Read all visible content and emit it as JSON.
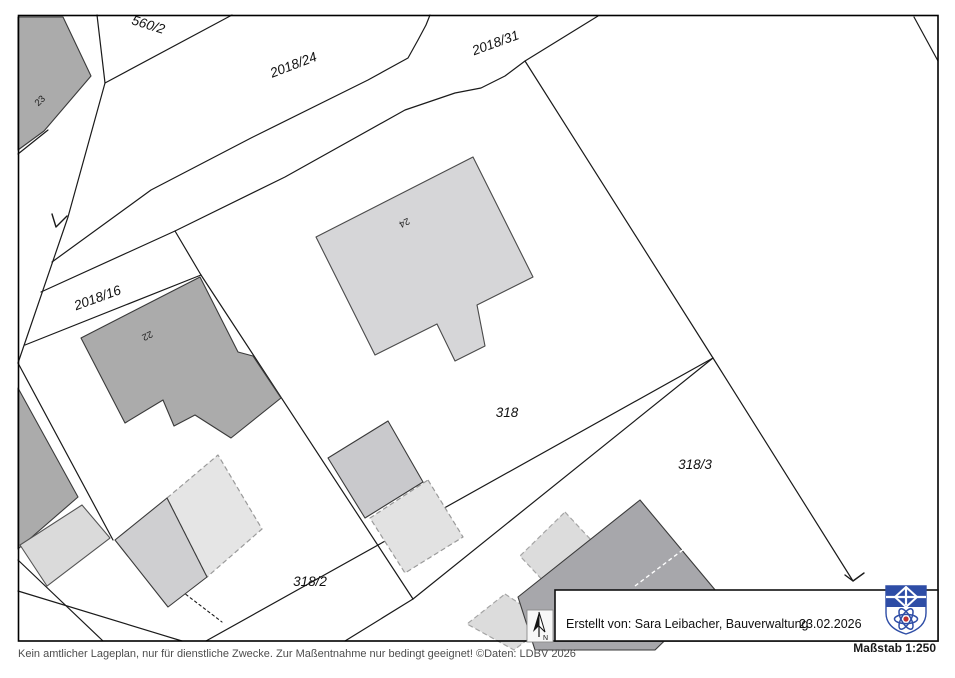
{
  "map": {
    "parcels": {
      "p560_2": "560/2",
      "p2018_24": "2018/24",
      "p2018_31": "2018/31",
      "p2018_16": "2018/16",
      "p318": "318",
      "p318_3": "318/3",
      "p318_2": "318/2"
    },
    "houses": {
      "h23": "23",
      "h22": "22",
      "h24": "24"
    }
  },
  "north": {
    "label": "N"
  },
  "info_box": {
    "created_by": "Erstellt von: Sara Leibacher, Bauverwaltung",
    "date": "23.02.2026"
  },
  "scale": {
    "label": "Maßstab 1:250"
  },
  "footer": {
    "disclaimer": "Kein amtlicher Lageplan, nur für dienstliche Zwecke. Zur Maßentnahme nur bedingt geeignet! ©Daten: LDBV 2026"
  },
  "colors": {
    "building_dark": "#ababab",
    "building_mid": "#cfcfd1",
    "building_light": "#d6d6d8",
    "building_ghost": "#e3e3e3",
    "outline": "#1a1a1a",
    "shield_blue": "#2e4da6",
    "shield_red": "#c03030"
  }
}
